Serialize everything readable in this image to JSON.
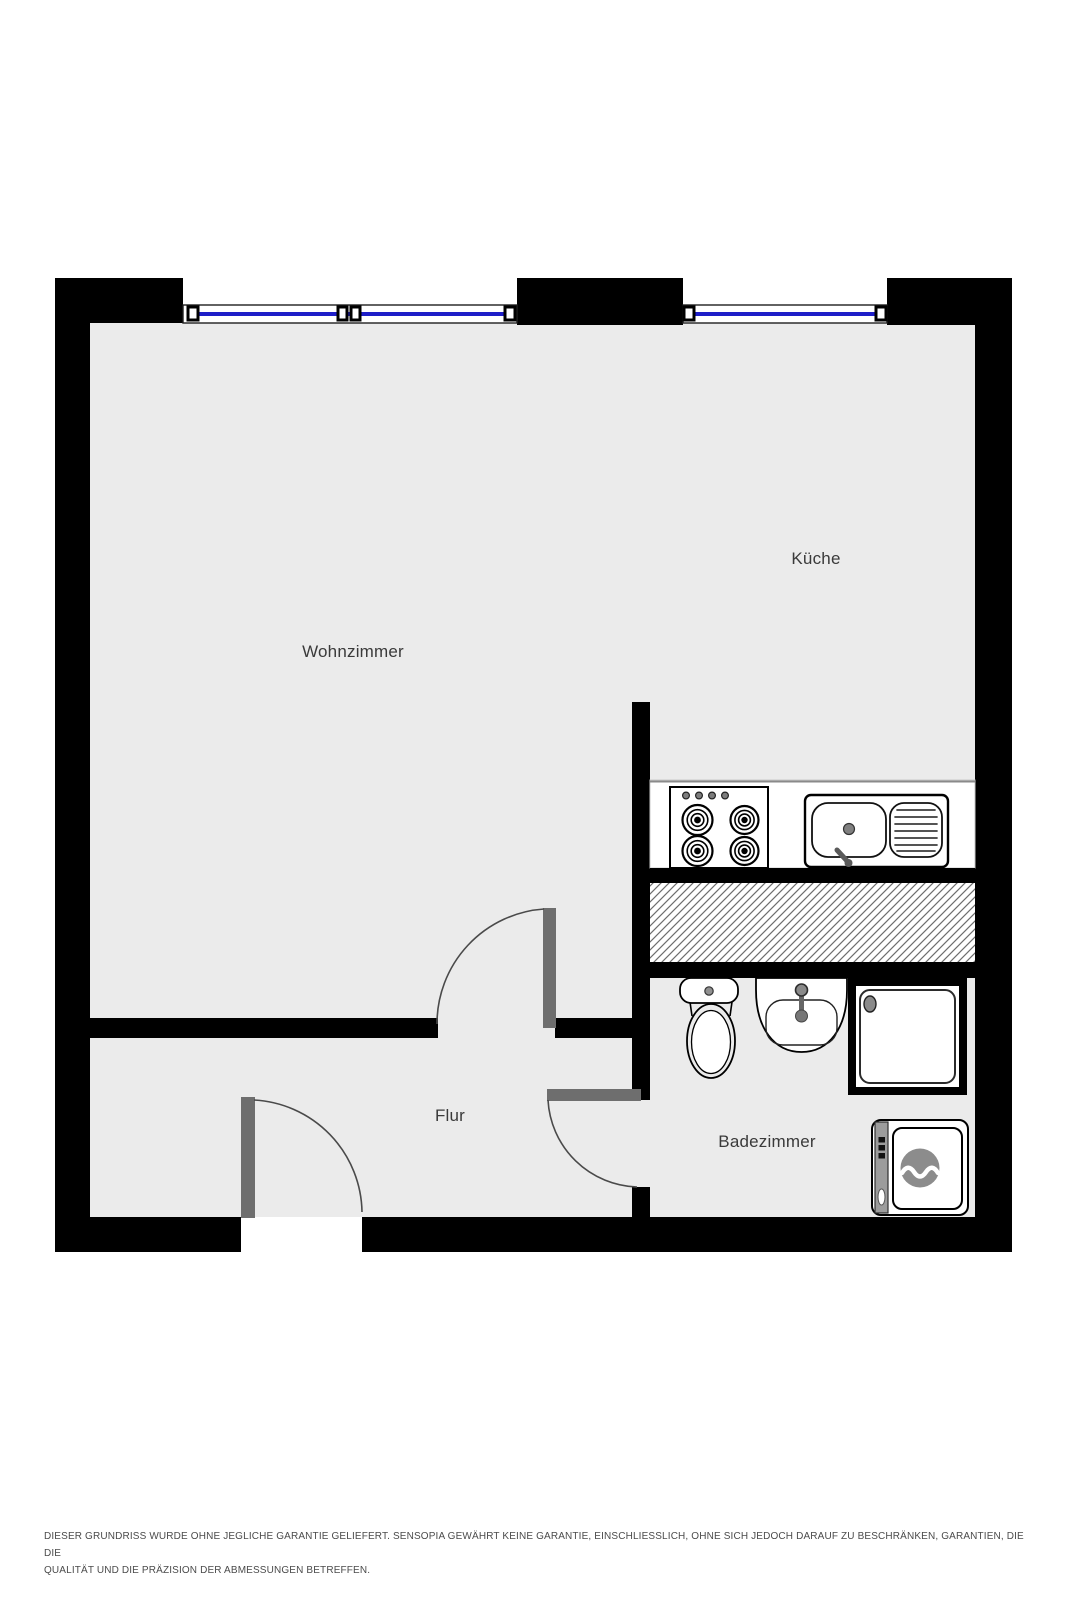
{
  "floorplan": {
    "rooms": [
      {
        "name": "living-room",
        "label": "Wohnzimmer"
      },
      {
        "name": "kitchen",
        "label": "Küche"
      },
      {
        "name": "hallway",
        "label": "Flur"
      },
      {
        "name": "bathroom",
        "label": "Badezimmer"
      }
    ],
    "fixtures": [
      "window-icon",
      "window-icon",
      "stove-icon",
      "kitchen-sink-icon",
      "shaft-hatch",
      "toilet-icon",
      "washbasin-icon",
      "shower-icon",
      "washing-machine-icon",
      "door-arc-icon",
      "door-arc-icon",
      "door-arc-icon"
    ],
    "colors": {
      "wall": "#000000",
      "floor": "#ebebeb",
      "window_glass": "#1e1ec8",
      "door_leaf": "#6e6e6e",
      "hatch_line": "#6e6e6e",
      "label_text": "#3a3a3a",
      "disclaimer_text": "#4b4b4b"
    }
  },
  "disclaimer": {
    "line1": "DIESER GRUNDRISS WURDE OHNE JEGLICHE GARANTIE GELIEFERT. SENSOPIA GEWÄHRT KEINE GARANTIE, EINSCHLIESSLICH, OHNE SICH JEDOCH DARAUF ZU BESCHRÄNKEN, GARANTIEN, DIE DIE",
    "line2": "QUALITÄT UND DIE PRÄZISION DER ABMESSUNGEN BETREFFEN."
  }
}
